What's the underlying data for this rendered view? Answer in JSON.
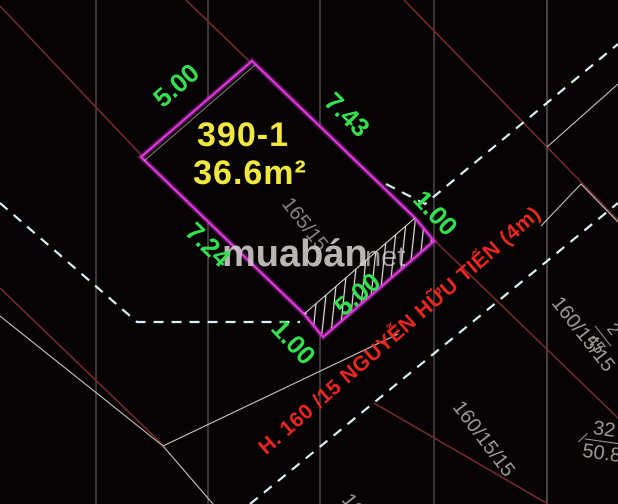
{
  "plot": {
    "number": "390-1",
    "area": "36.6m²",
    "dims": {
      "side_top_left": "5.00",
      "side_top_right": "7.43",
      "side_bottom_left": "7.24",
      "frontage": "5.00",
      "setback_top": "1.00",
      "setback_bottom": "1.00"
    }
  },
  "street": {
    "name": "H. 160 /15 NGUYỄN HỮU TIẾN (4m)"
  },
  "watermark": {
    "brand": "muabán",
    "tld": ".net"
  },
  "neighbors": {
    "alley_label": "165/15",
    "parcel_right": {
      "path": "160/15/15",
      "lot": "2",
      "area": "45"
    },
    "parcel_bottom": {
      "path": "160/15/15",
      "lot": "32",
      "area": "50.8"
    },
    "parcel_bottom_partial": "160"
  },
  "colors": {
    "background": "#070304",
    "plot_magenta": "#d935d9",
    "dim_green": "#35df4f",
    "label_yellow": "#f0e83e",
    "street_red": "#e82820",
    "road_cyan": "#d7f1f2",
    "boundary_maroon": "#722a2e",
    "grid_gray": "#8a8683",
    "parcel_white": "#ded9d2",
    "neighbor_gray": "#9b9894",
    "watermark_gray": "#d2d0cd",
    "hatch_white": "#e8e4dc"
  }
}
